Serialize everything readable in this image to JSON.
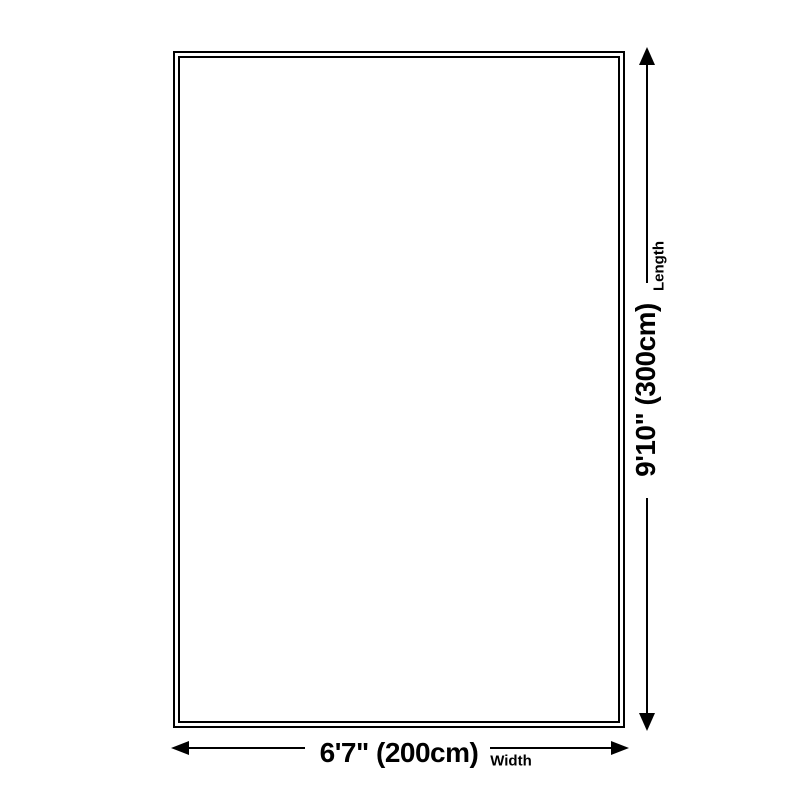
{
  "colors": {
    "background": "#ffffff",
    "line": "#000000"
  },
  "diagram": {
    "shape": "rectangle",
    "width": {
      "value": "6'7\" (200cm)",
      "caption": "Width"
    },
    "length": {
      "value": "9'10\" (300cm)",
      "caption": "Length"
    }
  },
  "icons": [
    "arrow-up-icon",
    "arrow-down-icon",
    "arrow-left-icon",
    "arrow-right-icon"
  ]
}
